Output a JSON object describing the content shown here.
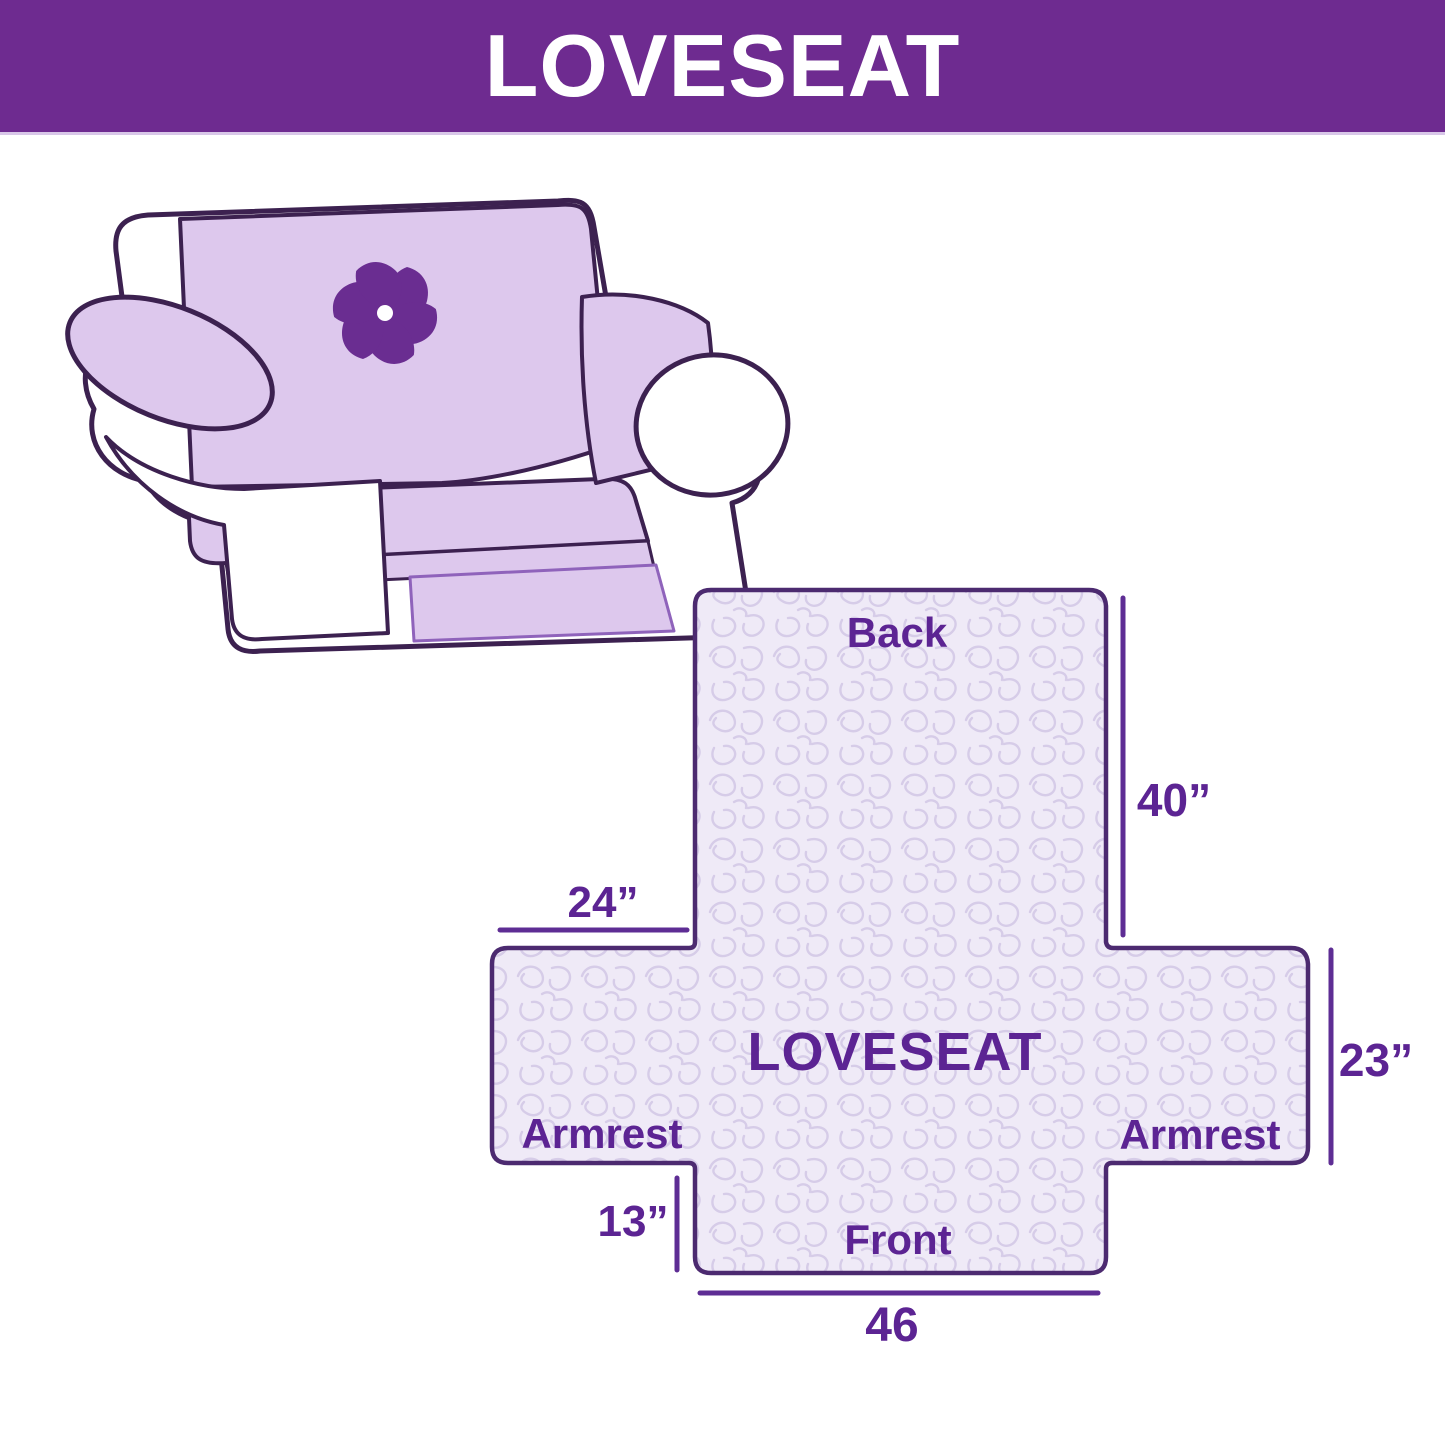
{
  "header": {
    "title": "LOVESEAT",
    "bg_color": "#6E2B90",
    "text_color": "#FFFFFF"
  },
  "illustration": {
    "description": "line-drawn loveseat sofa with lavender protective cover",
    "logo_icon": "pinwheel-logo",
    "cover_color": "#DDC8ED",
    "outline_color": "#3C2150",
    "logo_color": "#6A2D91"
  },
  "diagram": {
    "labels": {
      "back": "Back",
      "center": "LOVESEAT",
      "armrest_left": "Armrest",
      "armrest_right": "Armrest",
      "front": "Front"
    },
    "dimensions": {
      "back_height": "40”",
      "armrest_width": "24”",
      "armrest_depth": "23”",
      "front_drop": "13”",
      "front_width": "46"
    },
    "colors": {
      "panel_fill": "#EFEAF7",
      "pattern_line": "#D6CCE8",
      "border": "#4C2A70",
      "text": "#5C2493",
      "dim_line": "#5E2D94"
    }
  }
}
